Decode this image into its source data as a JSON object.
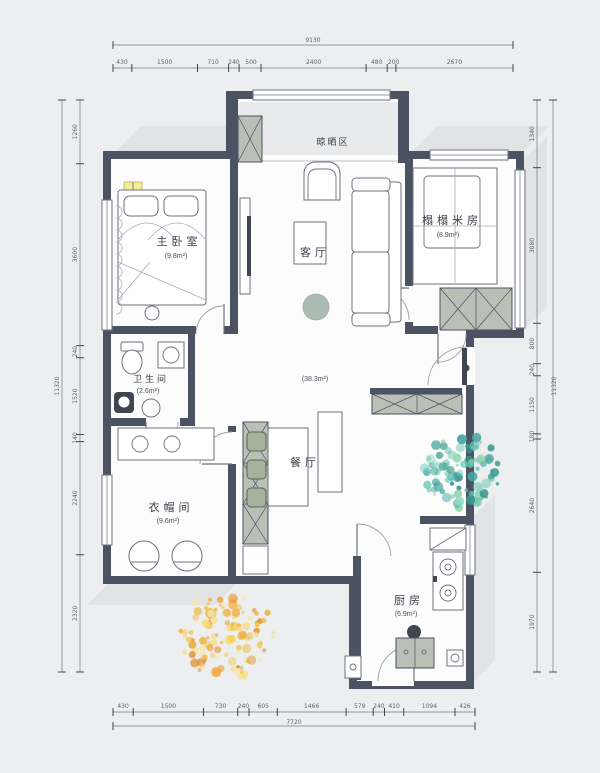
{
  "colors": {
    "bg": "#edeeef",
    "wall": "#4b5363",
    "line": "#6d727b",
    "cab": "#b9c0b6",
    "chair": "#a4b29e",
    "rug": "#9fb0a7",
    "lamp": "#f4ee9b",
    "dimtext": "#5f6265",
    "shadow": "#d9dbdc",
    "tree_green": [
      "#58c0ae",
      "#7bcf9e",
      "#47a89e",
      "#93d9c2",
      "#39998f",
      "#6cc7b7"
    ],
    "tree_yellow": [
      "#f2c94c",
      "#efa83c",
      "#f7dd78",
      "#e2913a",
      "#f5e9a8",
      "#f0b84e"
    ]
  },
  "rooms": {
    "master_bedroom": {
      "name": "主卧室",
      "area": "(9.8m²)"
    },
    "tatami": {
      "name": "榻榻米房",
      "area": "(8.9m²)"
    },
    "living": {
      "name": "客厅"
    },
    "total_area": "(38.3m²)",
    "bathroom": {
      "name": "卫生间",
      "area": "(2.6m²)"
    },
    "cloakroom": {
      "name": "衣帽间",
      "area": "(9.6m²)"
    },
    "dining": {
      "name": "餐厅"
    },
    "kitchen": {
      "name": "厨房",
      "area": "(6.9m²)"
    },
    "drying": {
      "name": "晾晒区"
    }
  },
  "dimensions": {
    "top": {
      "total": "9130",
      "segments": [
        "430",
        "1500",
        "710",
        "240",
        "500",
        "2400",
        "480",
        "200",
        "2670"
      ]
    },
    "bottom": {
      "total": "7720",
      "segments": [
        "430",
        "1500",
        "730",
        "240",
        "605",
        "1466",
        "579",
        "240",
        "410",
        "1094",
        "426"
      ]
    },
    "left": {
      "total": "11320",
      "segments": [
        "1260",
        "3600",
        "240",
        "1520",
        "140",
        "2240",
        "2320"
      ]
    },
    "right": {
      "total": "11320",
      "segments": [
        "1340",
        "3080",
        "800",
        "240",
        "1150",
        "100",
        "2640",
        "1970"
      ]
    }
  },
  "trees": [
    {
      "name": "tree-right",
      "cx": 462,
      "cy": 471,
      "r": 39,
      "count": 95,
      "palette": "tree_green",
      "seed": 7
    },
    {
      "name": "tree-bottom",
      "cx": 227,
      "cy": 635,
      "r": 47,
      "count": 120,
      "palette": "tree_yellow",
      "seed": 13
    }
  ]
}
